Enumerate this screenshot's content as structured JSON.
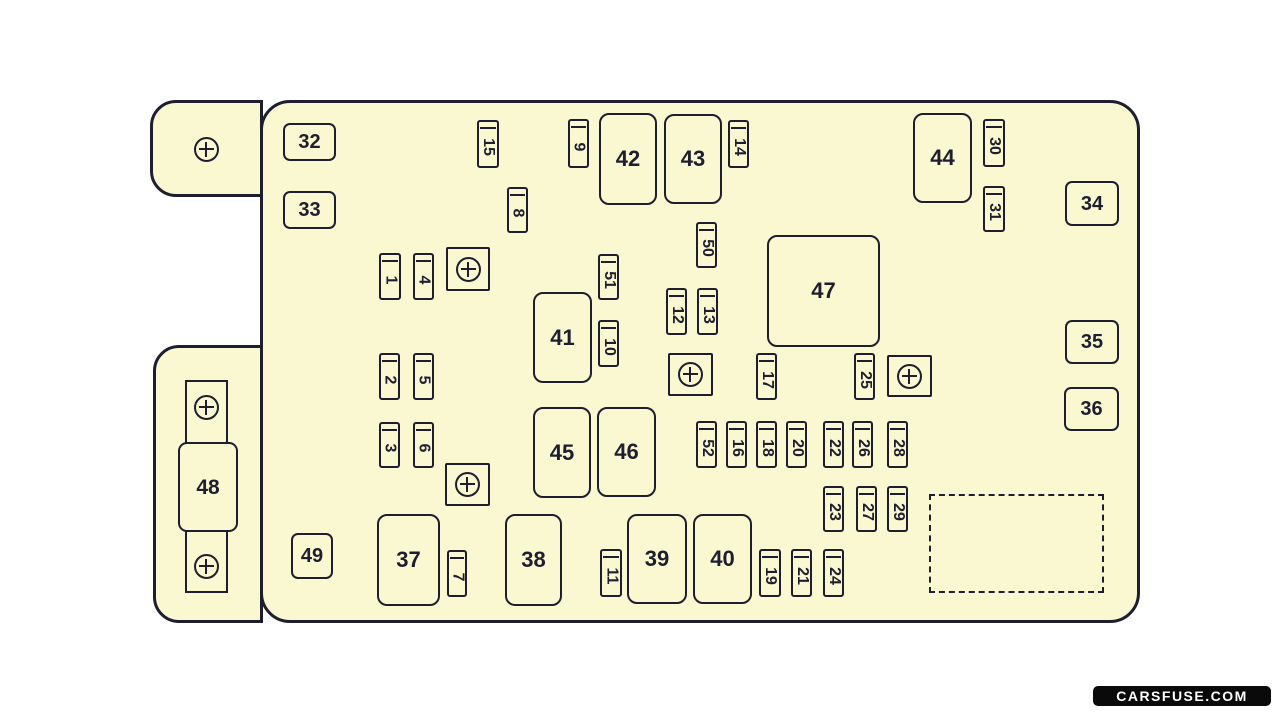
{
  "colors": {
    "panel_fill": "#faf8d0",
    "line": "#1e1e30",
    "badge_bg": "#0a0a0a",
    "badge_text": "#ffffff"
  },
  "watermark": {
    "text": "CARSFUSE.COM"
  },
  "elements": {
    "main_fuse": {
      "label": "48",
      "x": 178,
      "y": 442,
      "w": 60,
      "h": 90
    },
    "relays": [
      {
        "label": "37",
        "x": 377,
        "y": 514,
        "w": 63,
        "h": 92
      },
      {
        "label": "38",
        "x": 505,
        "y": 514,
        "w": 57,
        "h": 92
      },
      {
        "label": "39",
        "x": 627,
        "y": 514,
        "w": 60,
        "h": 90
      },
      {
        "label": "40",
        "x": 693,
        "y": 514,
        "w": 59,
        "h": 90
      },
      {
        "label": "41",
        "x": 533,
        "y": 292,
        "w": 59,
        "h": 91
      },
      {
        "label": "42",
        "x": 599,
        "y": 113,
        "w": 58,
        "h": 92
      },
      {
        "label": "43",
        "x": 664,
        "y": 114,
        "w": 58,
        "h": 90
      },
      {
        "label": "44",
        "x": 913,
        "y": 113,
        "w": 59,
        "h": 90
      },
      {
        "label": "45",
        "x": 533,
        "y": 407,
        "w": 58,
        "h": 91
      },
      {
        "label": "46",
        "x": 597,
        "y": 407,
        "w": 59,
        "h": 90
      },
      {
        "label": "47",
        "x": 767,
        "y": 235,
        "w": 113,
        "h": 112
      }
    ],
    "mini_squares": [
      {
        "label": "32",
        "x": 283,
        "y": 123,
        "w": 53,
        "h": 38
      },
      {
        "label": "33",
        "x": 283,
        "y": 191,
        "w": 53,
        "h": 38
      },
      {
        "label": "34",
        "x": 1065,
        "y": 181,
        "w": 54,
        "h": 45
      },
      {
        "label": "35",
        "x": 1065,
        "y": 320,
        "w": 54,
        "h": 44
      },
      {
        "label": "36",
        "x": 1064,
        "y": 387,
        "w": 55,
        "h": 44
      },
      {
        "label": "49",
        "x": 291,
        "y": 533,
        "w": 42,
        "h": 46
      }
    ],
    "mini_fuses": [
      {
        "label": "1",
        "x": 379,
        "y": 253,
        "w": 22,
        "h": 47
      },
      {
        "label": "2",
        "x": 379,
        "y": 353,
        "w": 21,
        "h": 47
      },
      {
        "label": "3",
        "x": 379,
        "y": 422,
        "w": 21,
        "h": 46
      },
      {
        "label": "4",
        "x": 413,
        "y": 253,
        "w": 21,
        "h": 47
      },
      {
        "label": "5",
        "x": 413,
        "y": 353,
        "w": 21,
        "h": 47
      },
      {
        "label": "6",
        "x": 413,
        "y": 422,
        "w": 21,
        "h": 46
      },
      {
        "label": "7",
        "x": 447,
        "y": 550,
        "w": 20,
        "h": 47
      },
      {
        "label": "8",
        "x": 507,
        "y": 187,
        "w": 21,
        "h": 46
      },
      {
        "label": "9",
        "x": 568,
        "y": 119,
        "w": 21,
        "h": 49
      },
      {
        "label": "10",
        "x": 598,
        "y": 320,
        "w": 21,
        "h": 47
      },
      {
        "label": "11",
        "x": 600,
        "y": 549,
        "w": 22,
        "h": 48
      },
      {
        "label": "12",
        "x": 666,
        "y": 288,
        "w": 21,
        "h": 47
      },
      {
        "label": "13",
        "x": 697,
        "y": 288,
        "w": 21,
        "h": 47
      },
      {
        "label": "14",
        "x": 728,
        "y": 120,
        "w": 21,
        "h": 48
      },
      {
        "label": "15",
        "x": 477,
        "y": 120,
        "w": 22,
        "h": 48
      },
      {
        "label": "16",
        "x": 726,
        "y": 421,
        "w": 21,
        "h": 47
      },
      {
        "label": "17",
        "x": 756,
        "y": 353,
        "w": 21,
        "h": 47
      },
      {
        "label": "18",
        "x": 756,
        "y": 421,
        "w": 21,
        "h": 47
      },
      {
        "label": "19",
        "x": 759,
        "y": 549,
        "w": 22,
        "h": 48
      },
      {
        "label": "20",
        "x": 786,
        "y": 421,
        "w": 21,
        "h": 47
      },
      {
        "label": "21",
        "x": 791,
        "y": 549,
        "w": 21,
        "h": 48
      },
      {
        "label": "22",
        "x": 823,
        "y": 421,
        "w": 21,
        "h": 47
      },
      {
        "label": "23",
        "x": 823,
        "y": 486,
        "w": 21,
        "h": 46
      },
      {
        "label": "24",
        "x": 823,
        "y": 549,
        "w": 21,
        "h": 48
      },
      {
        "label": "25",
        "x": 854,
        "y": 353,
        "w": 21,
        "h": 47
      },
      {
        "label": "26",
        "x": 852,
        "y": 421,
        "w": 21,
        "h": 47
      },
      {
        "label": "27",
        "x": 856,
        "y": 486,
        "w": 21,
        "h": 46
      },
      {
        "label": "28",
        "x": 887,
        "y": 421,
        "w": 21,
        "h": 47
      },
      {
        "label": "29",
        "x": 887,
        "y": 486,
        "w": 21,
        "h": 46
      },
      {
        "label": "30",
        "x": 983,
        "y": 119,
        "w": 22,
        "h": 48
      },
      {
        "label": "31",
        "x": 983,
        "y": 186,
        "w": 22,
        "h": 46
      },
      {
        "label": "50",
        "x": 696,
        "y": 222,
        "w": 21,
        "h": 46
      },
      {
        "label": "51",
        "x": 598,
        "y": 254,
        "w": 21,
        "h": 46
      },
      {
        "label": "52",
        "x": 696,
        "y": 421,
        "w": 21,
        "h": 47
      }
    ],
    "bolt_terminals": [
      {
        "x": 446,
        "y": 247,
        "w": 44,
        "h": 44
      },
      {
        "x": 668,
        "y": 353,
        "w": 45,
        "h": 43
      },
      {
        "x": 887,
        "y": 355,
        "w": 45,
        "h": 42
      },
      {
        "x": 445,
        "y": 463,
        "w": 45,
        "h": 43
      }
    ],
    "tab_bolts": [
      {
        "x": 194,
        "y": 137
      },
      {
        "x": 194,
        "y": 395
      },
      {
        "x": 194,
        "y": 554
      }
    ],
    "spare_slot": {
      "x": 929,
      "y": 494,
      "w": 175,
      "h": 99
    }
  }
}
